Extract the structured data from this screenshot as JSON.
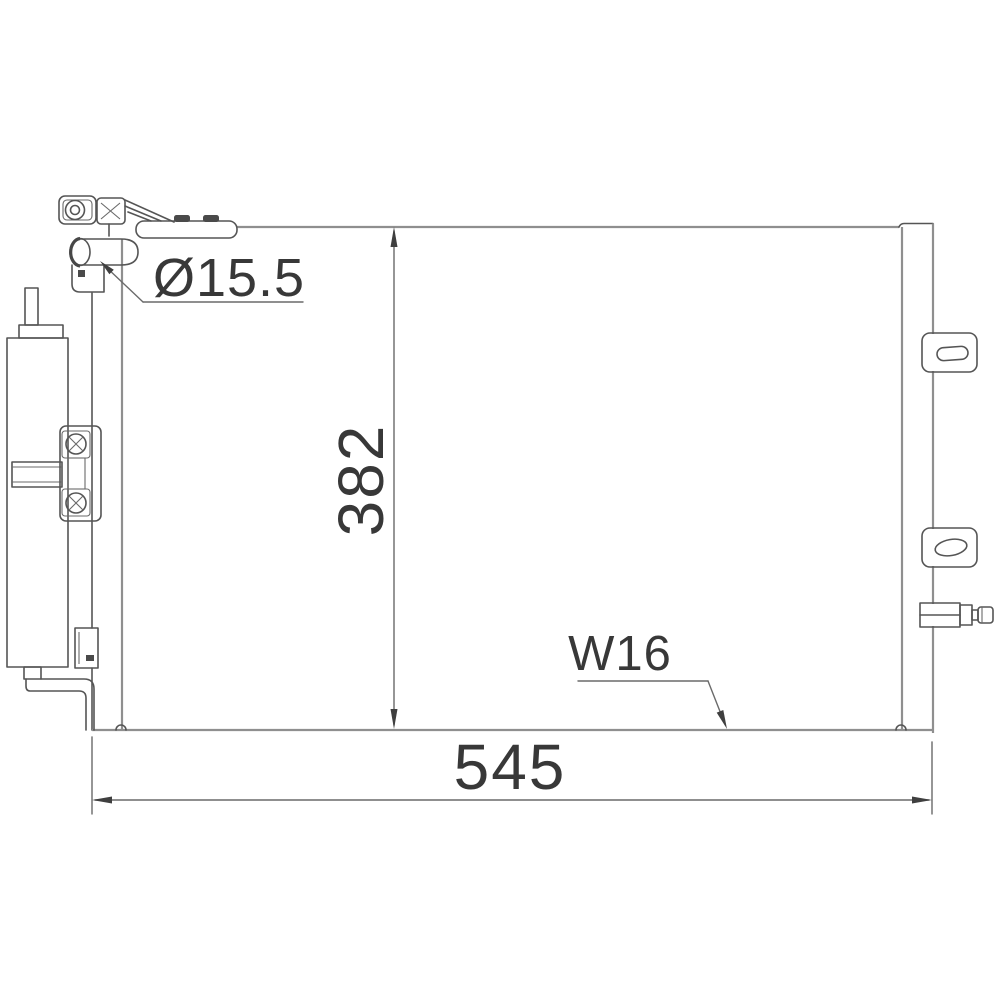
{
  "labels": {
    "diameter_callout": "Ø15.5",
    "height_dimension": "382",
    "width_dimension": "545",
    "pipe_thread_callout": "W16"
  },
  "colors": {
    "line": "#555555",
    "line_light": "#8f8f8f",
    "text": "#383838",
    "background": "#ffffff"
  }
}
